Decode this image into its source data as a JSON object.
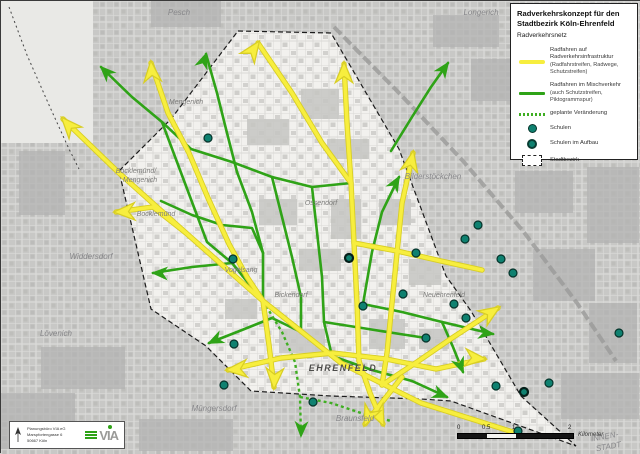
{
  "legend": {
    "title_line1": "Radverkehrskonzept für den",
    "title_line2": "Stadtbezirk Köln-Ehrenfeld",
    "subtitle": "Radverkehrsnetz",
    "items": [
      {
        "symbol": "line-yellow",
        "lines": [
          "Radfahren auf Radverkehrsinfrastruktur",
          "(Radfahrstreifen, Radwege, Schutzstreifen)"
        ]
      },
      {
        "symbol": "line-green",
        "lines": [
          "Radfahren im Mischverkehr",
          "(auch Schutzstreifen, Piktogrammspur)"
        ]
      },
      {
        "symbol": "line-green-dashed",
        "lines": [
          "geplante Veränderung"
        ]
      },
      {
        "symbol": "dot-school",
        "lines": [
          "Schulen"
        ]
      },
      {
        "symbol": "dot-school-construction",
        "lines": [
          "Schulen im Aufbau"
        ]
      },
      {
        "symbol": "district-box",
        "lines": [
          "Stadtbezirk"
        ]
      }
    ]
  },
  "credits": {
    "lines": [
      "Planungsbüro VIA eG",
      "Marspfortengasse 6",
      "50667 Köln"
    ],
    "logo_text": "VIA"
  },
  "scalebar": {
    "labels": [
      "0",
      "0.5",
      "1",
      "2"
    ],
    "unit": "Kilometer"
  },
  "colors": {
    "route_infrastructure": "#f7ee3e",
    "route_infrastructure_edge": "#d8ce25",
    "route_mixed": "#2fa317",
    "route_planned": "#3fae22",
    "school": "#0f8170",
    "map_outside": "#c8c8c6",
    "map_inside": "#f2f1ee",
    "boundary": "#1c1c1c"
  },
  "map": {
    "boundary": "237,30 330,32 398,148 445,275 470,310 520,395 575,445 450,400 420,398 330,395 250,390 205,345 150,308 118,170 170,118",
    "extra_boundary": "8,6 26,54 48,104 68,148 78,168",
    "railway": "333,26 400,94 462,160 522,230 576,302 615,360",
    "patches": [
      [
        150,
        0,
        70,
        26,
        "d"
      ],
      [
        432,
        14,
        66,
        32,
        "d"
      ],
      [
        470,
        58,
        44,
        42,
        "d"
      ],
      [
        586,
        166,
        52,
        76,
        "d"
      ],
      [
        514,
        170,
        58,
        42,
        "d"
      ],
      [
        532,
        248,
        62,
        52,
        "d"
      ],
      [
        588,
        302,
        48,
        60,
        "d"
      ],
      [
        18,
        150,
        46,
        64,
        "d"
      ],
      [
        40,
        346,
        84,
        42,
        "d"
      ],
      [
        0,
        392,
        74,
        56,
        "d"
      ],
      [
        138,
        418,
        94,
        32,
        "d"
      ],
      [
        560,
        372,
        78,
        46,
        "d"
      ],
      [
        246,
        118,
        42,
        26,
        "m"
      ],
      [
        300,
        88,
        38,
        30,
        "m"
      ],
      [
        258,
        198,
        38,
        26,
        "m"
      ],
      [
        330,
        198,
        30,
        40,
        "m"
      ],
      [
        378,
        198,
        32,
        26,
        "m"
      ],
      [
        298,
        248,
        42,
        22,
        "m"
      ],
      [
        408,
        258,
        32,
        26,
        "m"
      ],
      [
        278,
        328,
        46,
        24,
        "m"
      ],
      [
        368,
        318,
        36,
        30,
        "m"
      ],
      [
        326,
        138,
        42,
        20,
        "m"
      ],
      [
        224,
        298,
        32,
        20,
        "m"
      ],
      [
        418,
        328,
        30,
        20,
        "m"
      ]
    ],
    "routes_infrastructure": [
      "62,118 118,172 185,232 262,300 340,362 420,402 515,432",
      "150,62 167,112 188,152 207,197 228,243 246,276 262,300",
      "343,63 346,122 350,182 353,242 356,302 358,360",
      "257,42 291,92 321,142 350,182",
      "412,152 401,202 396,252 391,302 386,352 381,384",
      "115,211 152,206 185,232",
      "227,369 280,357 332,352 385,358 435,368 483,358",
      "262,300 268,344 273,386",
      "381,384 416,361 451,337 497,307",
      "353,242 396,250 440,260 481,269",
      "358,360 369,392 382,423",
      "401,376 382,400 364,423"
    ],
    "routes_mixed": [
      "100,66 131,96 161,121 190,148",
      "205,53 216,92 226,132 236,171",
      "152,272 191,266 231,262 262,300",
      "208,342 241,329 271,317 300,331",
      "190,148 231,161 271,176 311,186 350,182",
      "236,171 251,211 262,252 262,300",
      "311,186 316,231 321,276 323,321 331,355",
      "398,176 381,211 371,251 362,303",
      "362,303 401,311 441,321 492,333",
      "331,355 371,369 411,380 446,396",
      "441,321 452,346 462,371",
      "161,121 176,161 191,201 206,241 231,262",
      "160,200 191,214 221,224 251,227 262,252",
      "390,150 411,116 430,86 447,62",
      "271,176 281,216 291,256 300,296 300,331",
      "323,321 361,327 399,333 425,337"
    ],
    "routes_planned": [
      "262,300 281,331 294,361 299,396 300,435",
      "299,396 330,402 360,412 390,420"
    ],
    "arrows_infrastructure": [
      [
        62,
        118,
        -132
      ],
      [
        150,
        62,
        -95
      ],
      [
        257,
        42,
        -55
      ],
      [
        343,
        63,
        -90
      ],
      [
        412,
        152,
        -78
      ],
      [
        115,
        211,
        178
      ],
      [
        227,
        369,
        175
      ],
      [
        273,
        386,
        93
      ],
      [
        497,
        307,
        -33
      ],
      [
        483,
        358,
        5
      ],
      [
        382,
        423,
        65
      ],
      [
        364,
        423,
        115
      ]
    ],
    "arrows_mixed": [
      [
        100,
        66,
        -135
      ],
      [
        205,
        53,
        -70
      ],
      [
        152,
        272,
        182
      ],
      [
        208,
        342,
        155
      ],
      [
        492,
        333,
        8
      ],
      [
        462,
        371,
        68
      ],
      [
        446,
        396,
        22
      ],
      [
        447,
        62,
        -55
      ],
      [
        398,
        176,
        -60
      ],
      [
        300,
        435,
        92
      ]
    ],
    "schools": [
      [
        207,
        137
      ],
      [
        232,
        258
      ],
      [
        233,
        343
      ],
      [
        223,
        384
      ],
      [
        362,
        305
      ],
      [
        402,
        293
      ],
      [
        453,
        303
      ],
      [
        465,
        317
      ],
      [
        425,
        337
      ],
      [
        415,
        252
      ],
      [
        477,
        224
      ],
      [
        464,
        238
      ],
      [
        517,
        430
      ],
      [
        495,
        385
      ],
      [
        548,
        382
      ],
      [
        618,
        332
      ],
      [
        500,
        258
      ],
      [
        512,
        272
      ],
      [
        312,
        401
      ]
    ],
    "schools_construction": [
      [
        348,
        257
      ],
      [
        523,
        391
      ]
    ],
    "labels": [
      {
        "t": "Pesch",
        "x": 178,
        "y": 14,
        "s": "out"
      },
      {
        "t": "Longerich",
        "x": 480,
        "y": 14,
        "s": "out"
      },
      {
        "t": "Bilderstöckchen",
        "x": 432,
        "y": 178,
        "s": "out"
      },
      {
        "t": "Mengenich",
        "x": 185,
        "y": 103,
        "s": "in"
      },
      {
        "t": "Bocklemünd/",
        "x": 135,
        "y": 172,
        "s": "in"
      },
      {
        "t": "Mengenich",
        "x": 139,
        "y": 181,
        "s": "in"
      },
      {
        "t": "Bocklemünd",
        "x": 155,
        "y": 215,
        "s": "in"
      },
      {
        "t": "Widdersdorf",
        "x": 90,
        "y": 258,
        "s": "out"
      },
      {
        "t": "Lövenich",
        "x": 55,
        "y": 335,
        "s": "out"
      },
      {
        "t": "Ossendorf",
        "x": 320,
        "y": 204,
        "s": "in"
      },
      {
        "t": "Vogelsang",
        "x": 240,
        "y": 271,
        "s": "in"
      },
      {
        "t": "Bickendorf",
        "x": 290,
        "y": 296,
        "s": "in"
      },
      {
        "t": "Neuehrenfeld",
        "x": 443,
        "y": 296,
        "s": "in"
      },
      {
        "t": "EHRENFELD",
        "x": 342,
        "y": 370,
        "s": "caps"
      },
      {
        "t": "Müngersdorf",
        "x": 213,
        "y": 410,
        "s": "out"
      },
      {
        "t": "Braunsfeld",
        "x": 354,
        "y": 420,
        "s": "out"
      },
      {
        "t": "INNEN-",
        "x": 604,
        "y": 438,
        "s": "out",
        "r": -10
      },
      {
        "t": "STADT",
        "x": 608,
        "y": 448,
        "s": "out",
        "r": -10
      }
    ]
  }
}
